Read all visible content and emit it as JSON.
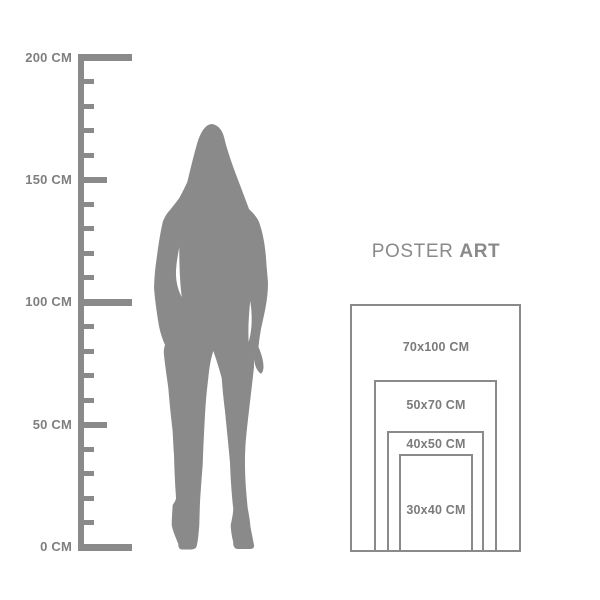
{
  "colors": {
    "shape_gray": "#8a8a8a",
    "ruler_text_gray": "#7f7f7f",
    "label_text_gray": "#7b7b7b",
    "background": "#ffffff"
  },
  "ruler": {
    "unit": "CM",
    "min_cm": 0,
    "max_cm": 200,
    "minor_step_cm": 10,
    "labeled_step_cm": 50,
    "labels": [
      "200 CM",
      "150 CM",
      "100 CM",
      "50 CM",
      "0 CM"
    ]
  },
  "figure": {
    "description": "standing-woman-silhouette"
  },
  "poster_guide": {
    "title": {
      "regular": "POSTER",
      "bold": "ART"
    },
    "sizes": [
      {
        "label": "70x100 CM",
        "width_cm": 70,
        "height_cm": 100
      },
      {
        "label": "50x70 CM",
        "width_cm": 50,
        "height_cm": 70
      },
      {
        "label": "40x50 CM",
        "width_cm": 40,
        "height_cm": 50
      },
      {
        "label": "30x40 CM",
        "width_cm": 30,
        "height_cm": 40
      }
    ]
  }
}
